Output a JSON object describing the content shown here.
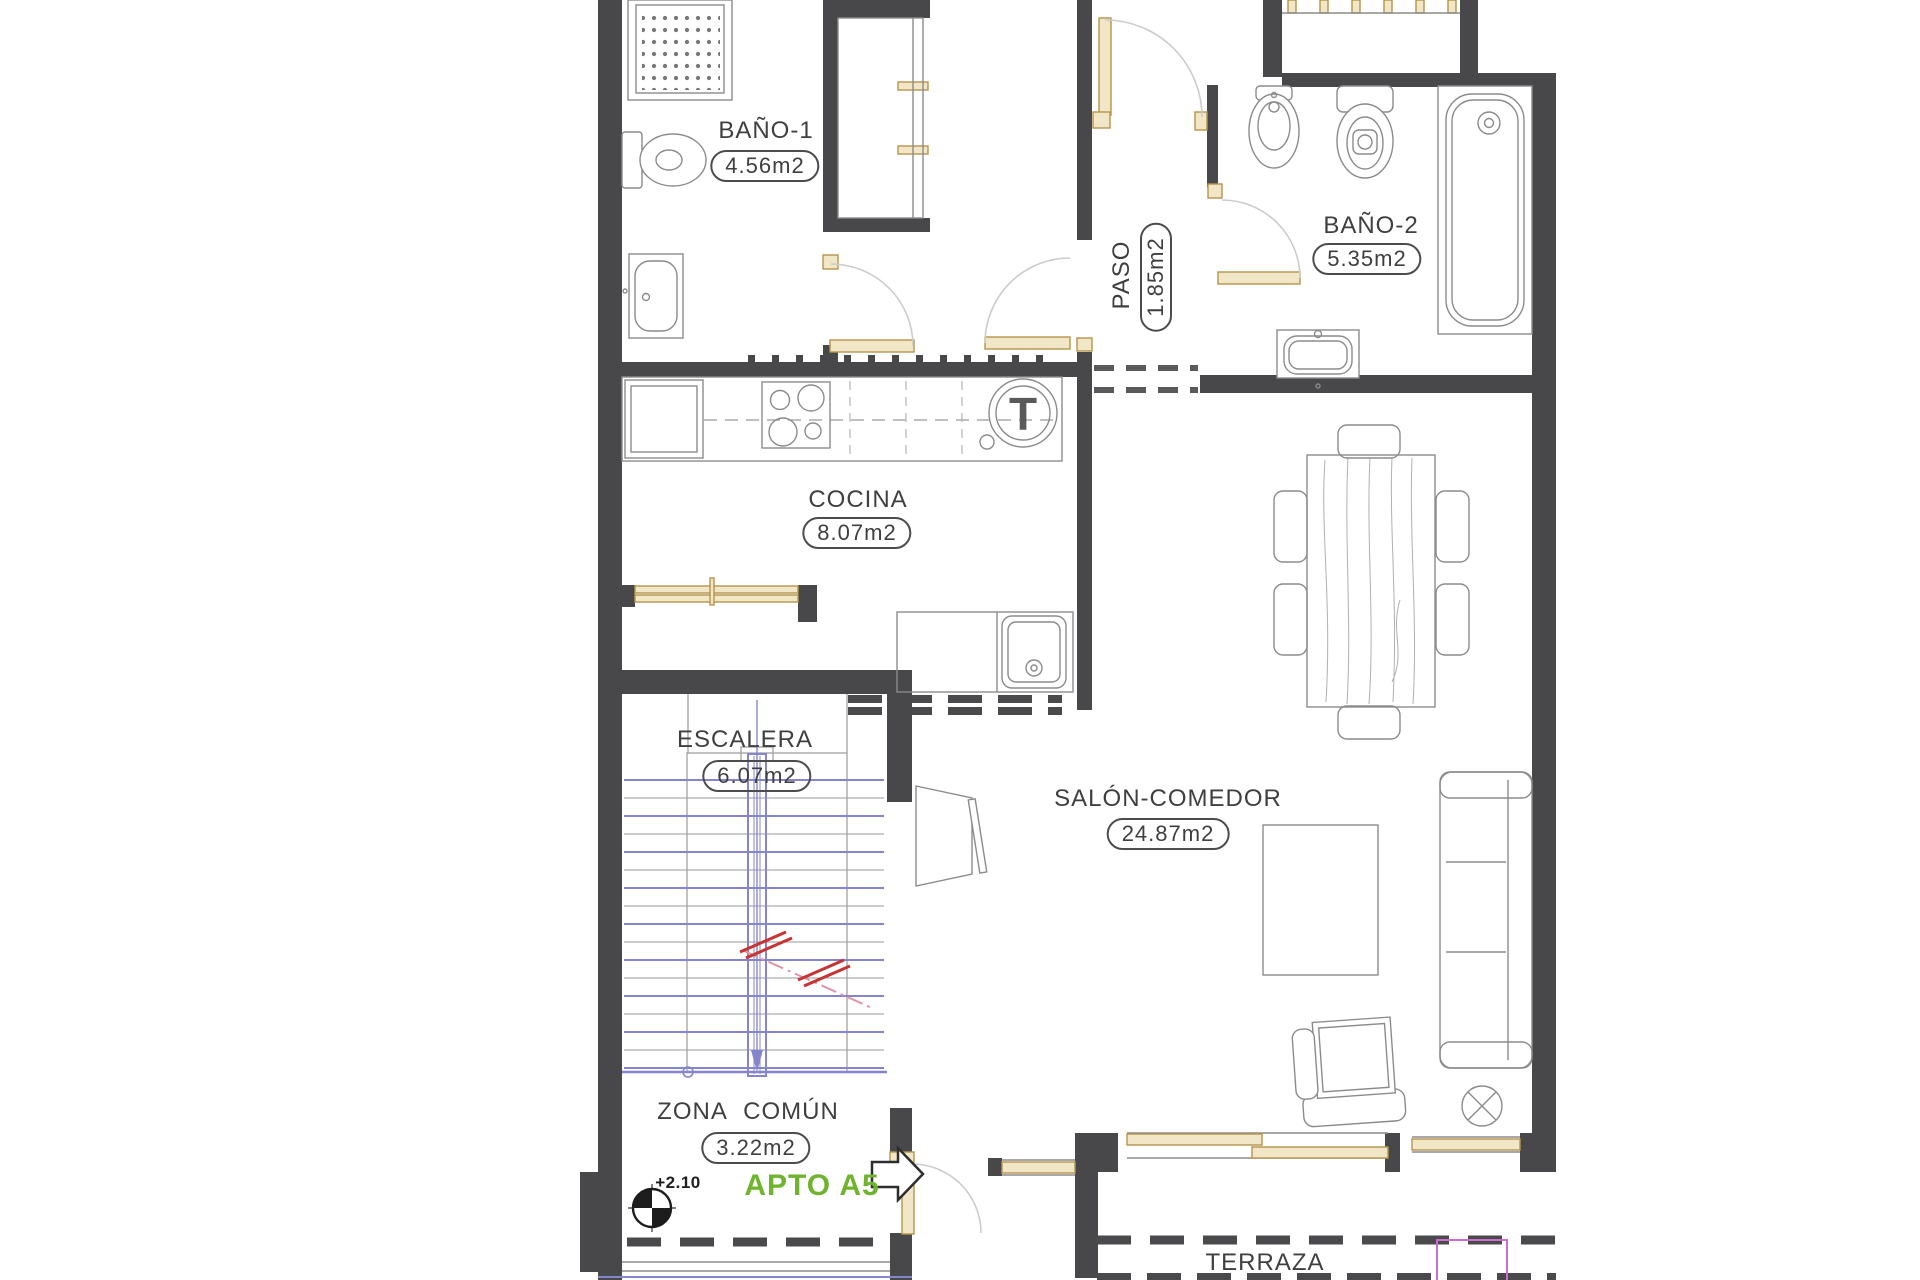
{
  "title": {
    "apartment": "APTO A5",
    "level": "+2.10"
  },
  "rooms": {
    "bano1": {
      "name": "BAÑO-1",
      "area": "4.56m2"
    },
    "bano2": {
      "name": "BAÑO-2",
      "area": "5.35m2"
    },
    "paso": {
      "name": "PASO",
      "area": "1.85m2"
    },
    "cocina": {
      "name": "COCINA",
      "area": "8.07m2"
    },
    "escalera": {
      "name": "ESCALERA",
      "area": "6.07m2"
    },
    "salon": {
      "name": "SALÓN-COMEDOR",
      "area": "24.87m2"
    },
    "zona": {
      "name": "ZONA COMÚN",
      "area": "3.22m2"
    },
    "terraza": {
      "name": "TERRAZA"
    }
  },
  "symbols": {
    "water_heater": "T"
  },
  "colors": {
    "wall": "#48484a",
    "wood": "#f1e6c6",
    "wood_border": "#b5954e",
    "stair_blue": "#8585cd",
    "line_gray": "#8b8b8b",
    "accent_green": "#6fb32e",
    "break_red": "#c63434",
    "break_pink": "#e294a6",
    "magenta": "#cf6ccf",
    "text": "#3f3f3f"
  }
}
